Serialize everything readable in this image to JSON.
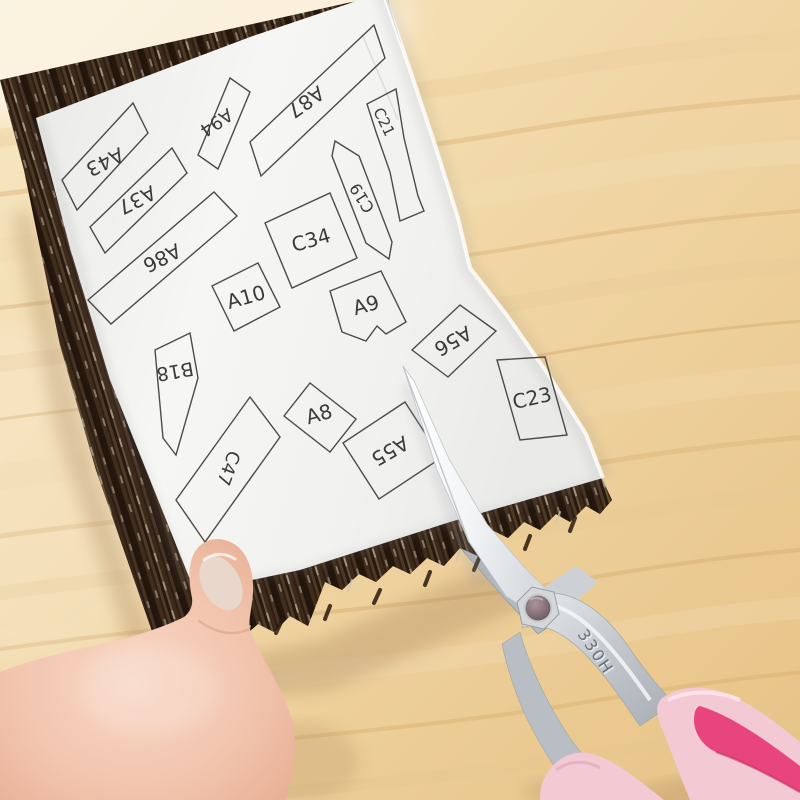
{
  "scene": {
    "description": "Photo: a hand holds a dark wood-grain repair sheet with a white pattern paper on top while pink-handled scissors cut out labelled pattern pieces on a light wooden desk",
    "desk": {
      "base_color": "#f2d9ac",
      "grain_color": "#dfbd85"
    },
    "sheet": {
      "backing_color": "#34241a",
      "paper_color": "#f4f4f2",
      "piece_outline_color": "#4b4b49",
      "piece_label_color": "#3b3b3b"
    },
    "scissors": {
      "engraving": "330H",
      "blade_color": "#f4f6f8",
      "handle_color": "#f3c9d4",
      "handle_accent_color": "#e8457f"
    },
    "hand": {
      "skin_color": "#f2c4ad",
      "nail_color": "#ead7cc"
    }
  },
  "pattern_pieces": [
    {
      "label": "A43",
      "points": "62,180 133,103 148,133 77,210",
      "label_x": 105,
      "label_y": 162,
      "label_rotation": 153,
      "size": 20
    },
    {
      "label": "A37",
      "points": "90,227 172,148 187,173 105,253",
      "label_x": 137,
      "label_y": 200,
      "label_rotation": 153,
      "size": 20
    },
    {
      "label": "A86",
      "points": "88,300 214,192 237,216 111,324",
      "label_x": 162,
      "label_y": 258,
      "label_rotation": 153,
      "size": 20
    },
    {
      "label": "A94",
      "points": "198,155 230,78 250,92 218,169",
      "label_x": 216,
      "label_y": 122,
      "label_rotation": 146,
      "size": 18
    },
    {
      "label": "A87",
      "points": "250,142 374,25 385,58 261,176",
      "label_x": 306,
      "label_y": 102,
      "label_rotation": 145,
      "size": 20
    },
    {
      "label": "C21",
      "points": "367,104 396,89 404,138 418,196 424,211 400,221 390,172 376,132",
      "label_x": 384,
      "label_y": 122,
      "label_rotation": 64,
      "size": 15
    },
    {
      "label": "C19",
      "points": "335,141 359,156 392,242 389,259 366,243 332,156",
      "label_x": 362,
      "label_y": 198,
      "label_rotation": 238,
      "size": 16
    },
    {
      "label": "C34",
      "points": "330,193 357,258 292,288 265,223",
      "label_x": 311,
      "label_y": 240,
      "label_rotation": -16,
      "size": 20
    },
    {
      "label": "A10",
      "points": "212,286 258,263 280,307 234,331",
      "label_x": 246,
      "label_y": 297,
      "label_rotation": -16,
      "size": 20
    },
    {
      "label": "A9",
      "points": "330,291 381,271 406,322 386,334 377,326 366,341 342,332",
      "label_x": 366,
      "label_y": 305,
      "label_rotation": -16,
      "size": 20
    },
    {
      "label": "B18",
      "points": "155,350 190,333 198,378 176,455 163,438",
      "label_x": 175,
      "label_y": 371,
      "label_rotation": 170,
      "size": 19
    },
    {
      "label": "A8",
      "points": "310,383 356,419 330,452 284,416",
      "label_x": 319,
      "label_y": 414,
      "label_rotation": -16,
      "size": 20
    },
    {
      "label": "C47",
      "points": "250,397 280,437 205,542 176,500",
      "label_x": 228,
      "label_y": 468,
      "label_rotation": 110,
      "size": 18
    },
    {
      "label": "A55",
      "points": "343,443 405,402 441,458 379,499",
      "label_x": 390,
      "label_y": 451,
      "label_rotation": 150,
      "size": 20
    },
    {
      "label": "A56",
      "points": "412,350 460,305 496,331 448,377",
      "label_x": 453,
      "label_y": 341,
      "label_rotation": 150,
      "size": 20
    },
    {
      "label": "C23",
      "points": "497,360 545,357 567,435 520,440",
      "label_x": 532,
      "label_y": 398,
      "label_rotation": -13,
      "size": 20
    }
  ]
}
